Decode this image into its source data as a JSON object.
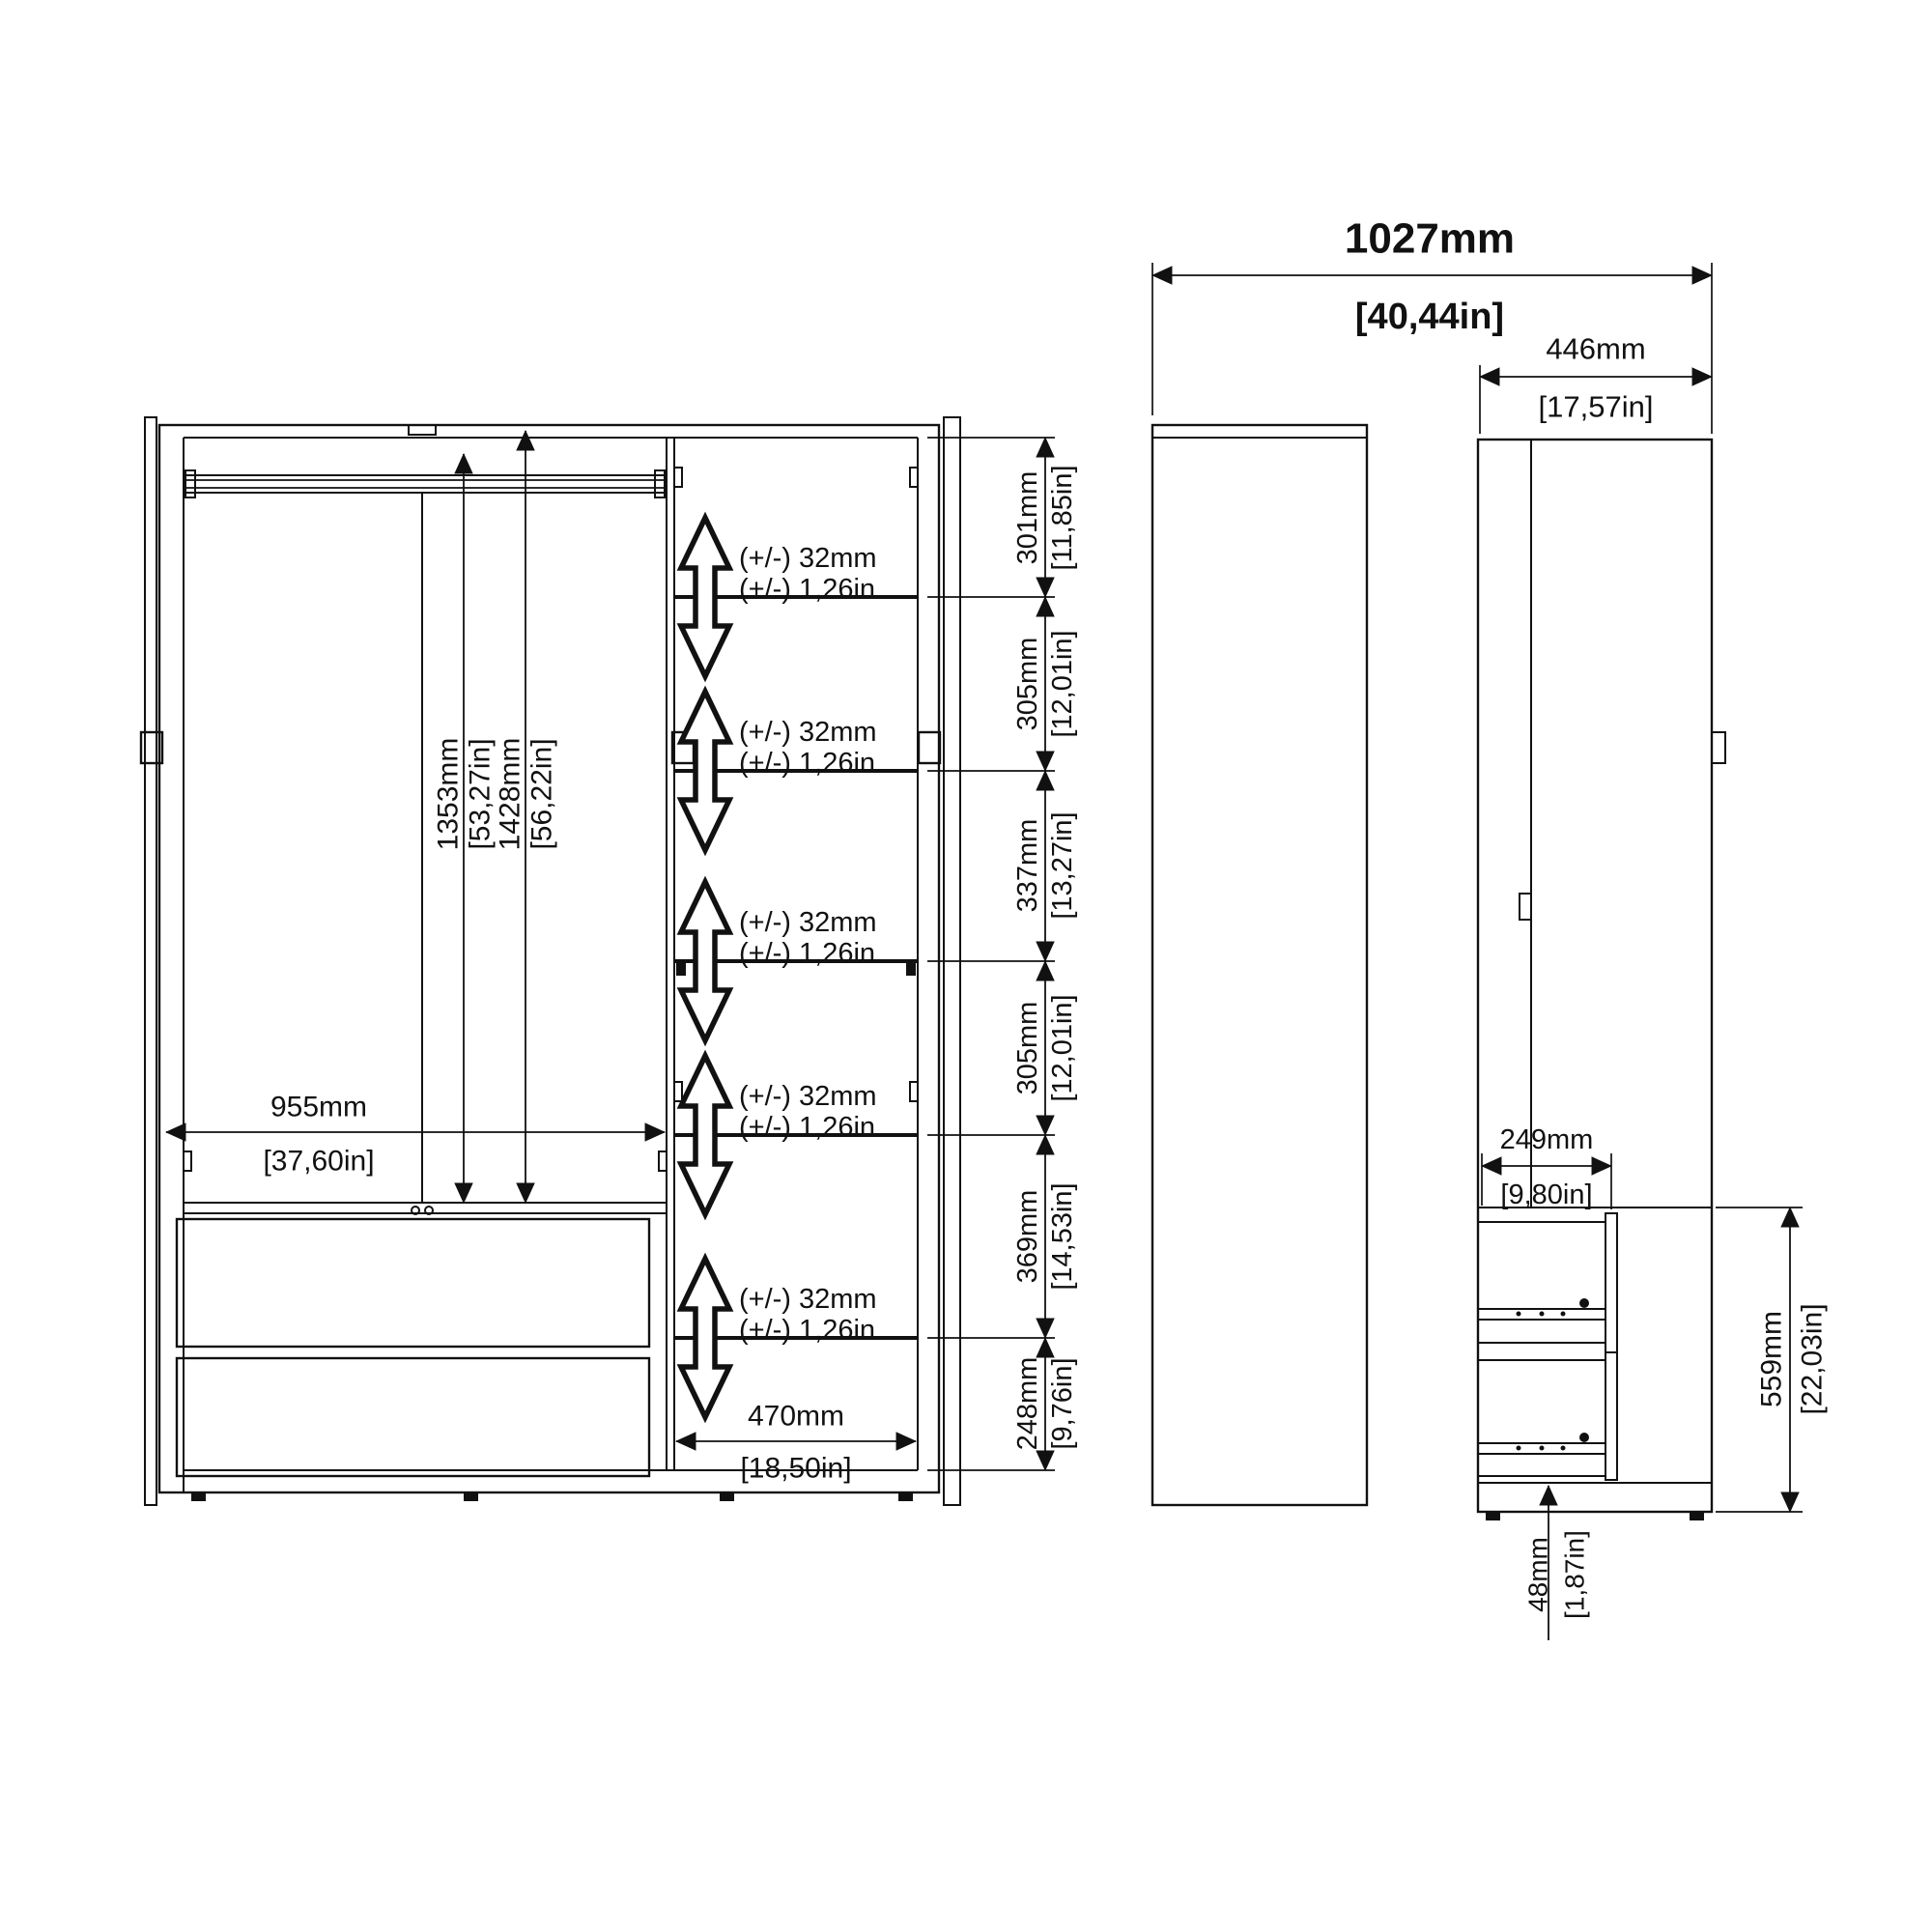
{
  "front_view": {
    "opening_width": {
      "mm": "955mm",
      "in": "[37,60in]"
    },
    "interior_height_1": {
      "mm": "1353mm",
      "in": "[53,27in]"
    },
    "interior_height_2": {
      "mm": "1428mm",
      "in": "[56,22in]"
    },
    "shelf_column_width": {
      "mm": "470mm",
      "in": "[18,50in]"
    },
    "adjustable_note": {
      "mm": "(+/-) 32mm",
      "in": "(+/-) 1,26in"
    },
    "shelf_gaps": [
      {
        "mm": "301mm",
        "in": "[11,85in]"
      },
      {
        "mm": "305mm",
        "in": "[12,01in]"
      },
      {
        "mm": "337mm",
        "in": "[13,27in]"
      },
      {
        "mm": "305mm",
        "in": "[12,01in]"
      },
      {
        "mm": "369mm",
        "in": "[14,53in]"
      },
      {
        "mm": "248mm",
        "in": "[9,76in]"
      }
    ]
  },
  "side_view": {
    "total_width_door_open": {
      "mm": "1027mm",
      "in": "[40,44in]"
    },
    "cabinet_depth": {
      "mm": "446mm",
      "in": "[17,57in]"
    },
    "drawer_depth": {
      "mm": "249mm",
      "in": "[9,80in]"
    },
    "drawer_zone_height": {
      "mm": "559mm",
      "in": "[22,03in]"
    },
    "plinth_height": {
      "mm": "48mm",
      "in": "[1,87in]"
    }
  }
}
